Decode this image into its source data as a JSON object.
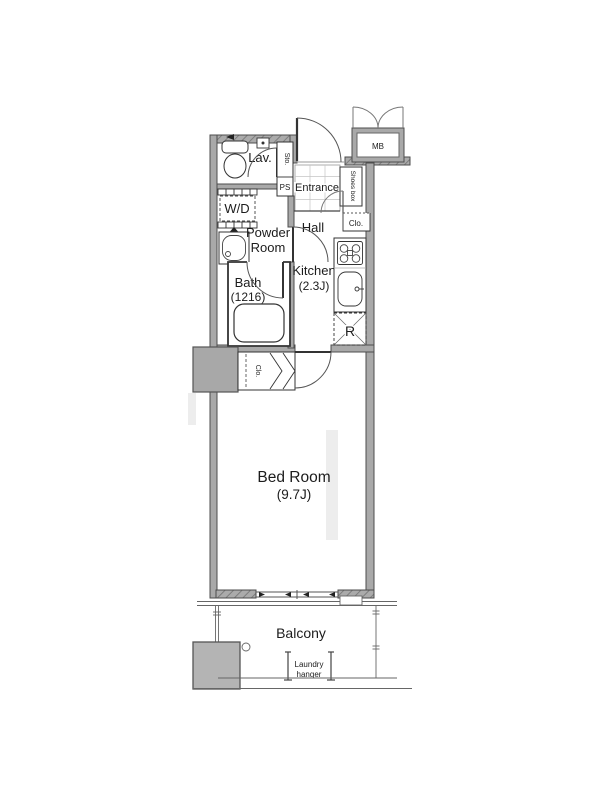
{
  "floorplan": {
    "rooms": {
      "lav": {
        "label": "Lav."
      },
      "washer_dryer": {
        "label": "W/D"
      },
      "powder_room": {
        "line1": "Powder",
        "line2": "Room"
      },
      "bath": {
        "label": "Bath",
        "size": "(1216)"
      },
      "kitchen": {
        "label": "Kitchen",
        "size": "(2.3J)"
      },
      "hall": {
        "label": "Hall"
      },
      "entrance": {
        "label": "Entrance"
      },
      "bedroom": {
        "label": "Bed Room",
        "size": "(9.7J)"
      },
      "balcony": {
        "label": "Balcony"
      }
    },
    "labels": {
      "meter_box": "MB",
      "shoes_box": "Shoes box",
      "hall_closet": "Clo.",
      "bedroom_closet": "Clo.",
      "storage": "Sto.",
      "pipe_space": "PS",
      "refrigerator_space": "R",
      "laundry_hanger_line1": "Laundry",
      "laundry_hanger_line2": "hanger"
    },
    "colors": {
      "wall_fill": "#a9a9a9",
      "wall_stroke": "#4d4d4d",
      "line": "#333333",
      "pillar_fill": "#a8a8a8",
      "equipment_box_fill": "#b4b4b4",
      "background": "#ffffff"
    }
  }
}
